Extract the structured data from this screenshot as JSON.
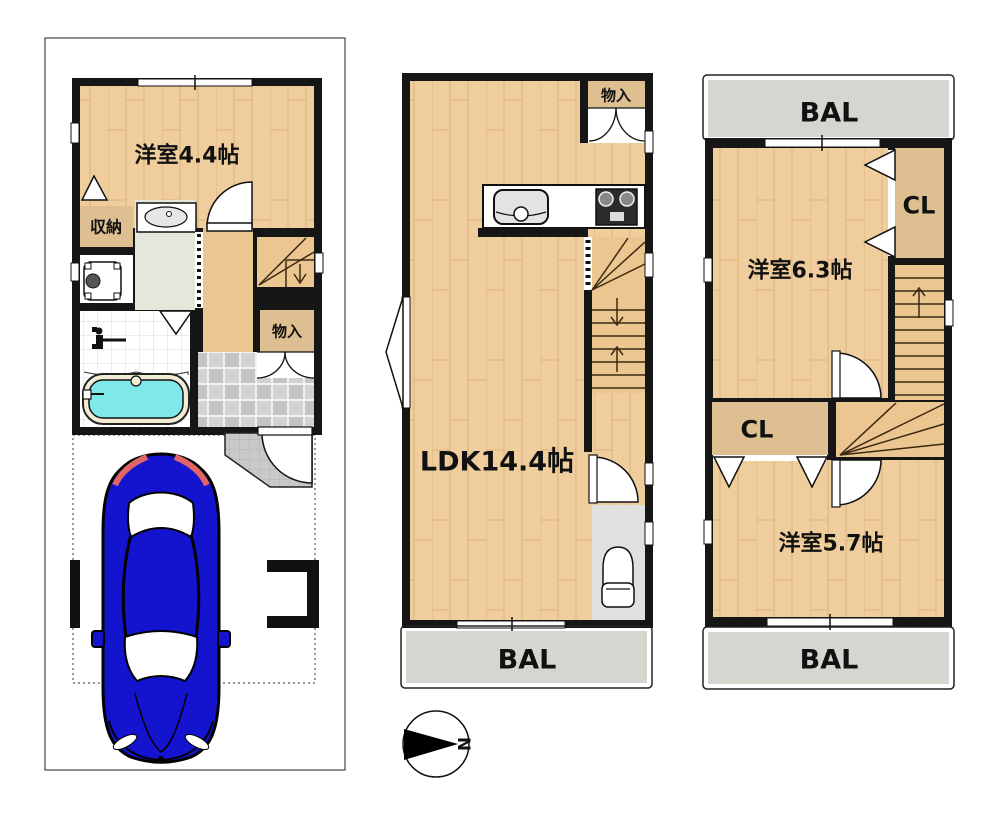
{
  "floor1": {
    "room_label": "洋室4.4帖",
    "storage_label": "収納",
    "closet_label": "物入"
  },
  "floor2": {
    "room_label": "LDK14.4帖",
    "closet_label": "物入",
    "balcony_label": "BAL"
  },
  "floor3": {
    "room1_label": "洋室6.3帖",
    "room2_label": "洋室5.7帖",
    "closet1_label": "CL",
    "closet2_label": "CL",
    "balcony_top_label": "BAL",
    "balcony_bottom_label": "BAL"
  },
  "compass": {
    "north_label": "N"
  },
  "colors": {
    "wall": "#161616",
    "wood_floor": "#efcd9c",
    "stair_floor": "#ecc690",
    "closet_floor": "#ddbf92",
    "balcony_floor": "#d6d6d1",
    "washroom_floor": "#e3e8da",
    "entrance_tile": "#c9c9c9",
    "bath_water": "#7fe9e9",
    "car_body": "#1414cf"
  }
}
